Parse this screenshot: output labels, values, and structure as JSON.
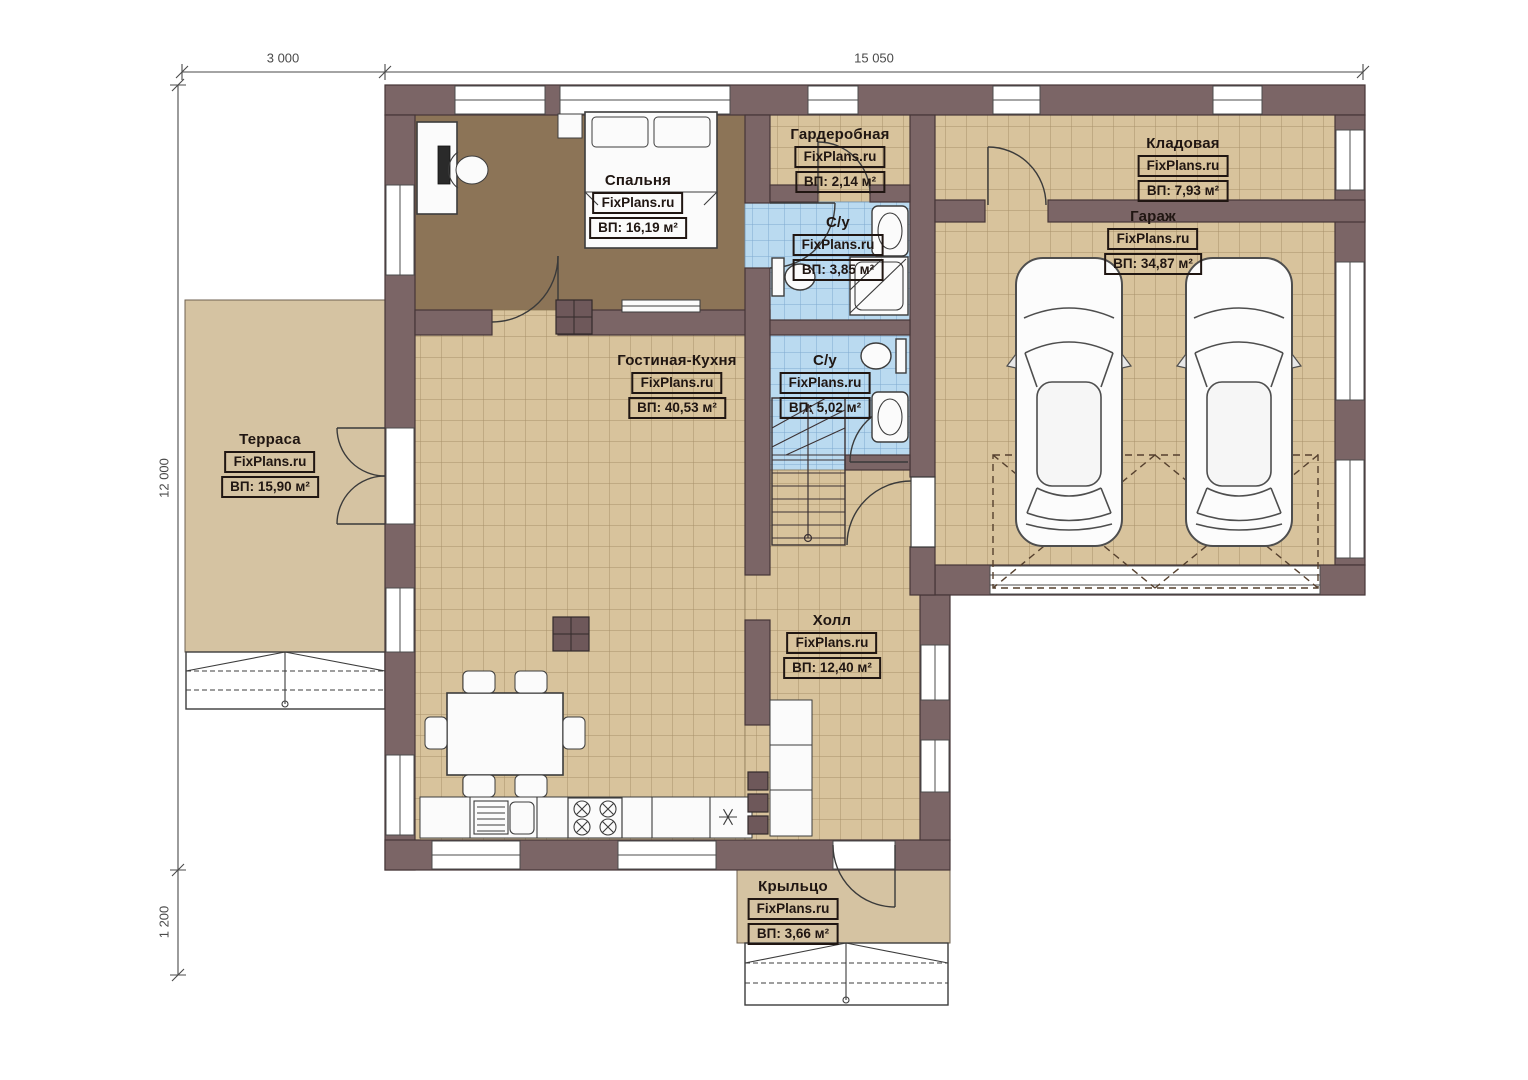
{
  "dimensions": {
    "top_left": "3 000",
    "top_main": "15 050",
    "left": "12 000",
    "bottom_left": "1 200"
  },
  "rooms": {
    "bedroom": {
      "name": "Спальня",
      "watermark": "FixPlans.ru",
      "area": "ВП: 16,19 м²"
    },
    "wardrobe": {
      "name": "Гардеробная",
      "watermark": "FixPlans.ru",
      "area": "ВП: 2,14 м²"
    },
    "bath1": {
      "name": "С/у",
      "watermark": "FixPlans.ru",
      "area": "ВП: 3,85 м²"
    },
    "storage": {
      "name": "Кладовая",
      "watermark": "FixPlans.ru",
      "area": "ВП: 7,93 м²"
    },
    "garage": {
      "name": "Гараж",
      "watermark": "FixPlans.ru",
      "area": "ВП: 34,87 м²"
    },
    "bath2": {
      "name": "С/у",
      "watermark": "FixPlans.ru",
      "area": "ВП: 5,02 м²"
    },
    "living_kitchen": {
      "name": "Гостиная-Кухня",
      "watermark": "FixPlans.ru",
      "area": "ВП: 40,53 м²"
    },
    "terrace": {
      "name": "Терраса",
      "watermark": "FixPlans.ru",
      "area": "ВП: 15,90 м²"
    },
    "hall": {
      "name": "Холл",
      "watermark": "FixPlans.ru",
      "area": "ВП: 12,40 м²"
    },
    "porch": {
      "name": "Крыльцо",
      "watermark": "FixPlans.ru",
      "area": "ВП: 3,66 м²"
    }
  },
  "colors": {
    "wall": "#7b6566",
    "wall_stroke": "#463637",
    "bedroom_floor": "#8c7457",
    "tile": "#d8c39c",
    "tile_line": "#a8906a",
    "bath_tile": "#badaf0",
    "bath_tile_line": "#7fa9cf",
    "outdoor": "#d5c3a2",
    "label_ink": "#201612",
    "dim_ink": "#4a4a4a",
    "post": "#6e585a"
  }
}
